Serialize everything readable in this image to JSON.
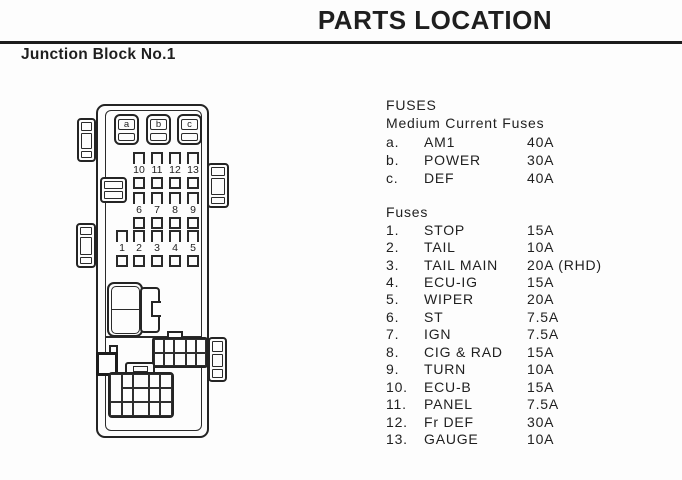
{
  "page": {
    "title": "PARTS LOCATION",
    "section_title": "Junction Block No.1"
  },
  "medium_fuses": {
    "heading": "FUSES",
    "subheading": "Medium Current Fuses",
    "items": [
      {
        "id": "a.",
        "name": "AM1",
        "amp": "40A"
      },
      {
        "id": "b.",
        "name": "POWER",
        "amp": "30A"
      },
      {
        "id": "c.",
        "name": "DEF",
        "amp": "40A"
      }
    ]
  },
  "fuses": {
    "heading": "Fuses",
    "items": [
      {
        "id": "1.",
        "name": "STOP",
        "amp": "15A"
      },
      {
        "id": "2.",
        "name": "TAIL",
        "amp": "10A"
      },
      {
        "id": "3.",
        "name": "TAIL MAIN",
        "amp": "20A (RHD)"
      },
      {
        "id": "4.",
        "name": "ECU-IG",
        "amp": "15A"
      },
      {
        "id": "5.",
        "name": "WIPER",
        "amp": "20A"
      },
      {
        "id": "6.",
        "name": "ST",
        "amp": "7.5A"
      },
      {
        "id": "7.",
        "name": "IGN",
        "amp": "7.5A"
      },
      {
        "id": "8.",
        "name": "CIG & RAD",
        "amp": "15A"
      },
      {
        "id": "9.",
        "name": "TURN",
        "amp": "10A"
      },
      {
        "id": "10.",
        "name": "ECU-B",
        "amp": "15A"
      },
      {
        "id": "11.",
        "name": "PANEL",
        "amp": "7.5A"
      },
      {
        "id": "12.",
        "name": "Fr DEF",
        "amp": "30A"
      },
      {
        "id": "13.",
        "name": "GAUGE",
        "amp": "10A"
      }
    ]
  },
  "diagram": {
    "medium_fuse_labels": [
      "a",
      "b",
      "c"
    ],
    "fuse_rows": [
      [
        "10",
        "11",
        "12",
        "13"
      ],
      [
        "6",
        "7",
        "8",
        "9"
      ],
      [
        "1",
        "2",
        "3",
        "4",
        "5"
      ]
    ]
  },
  "colors": {
    "ink": "#1c1c1c",
    "paper": "#fdfdfd"
  }
}
